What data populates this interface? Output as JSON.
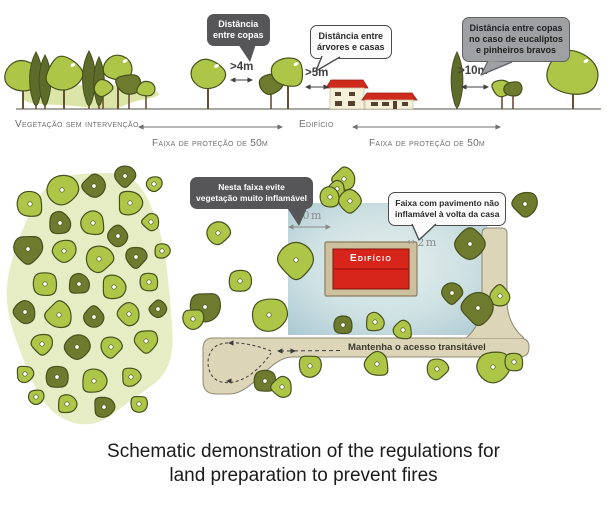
{
  "top_panel": {
    "bubble_copas": {
      "line1": "Distância",
      "line2": "entre copas"
    },
    "bubble_casas": {
      "line1": "Distância entre",
      "line2": "árvores e casas"
    },
    "bubble_eucaliptos": {
      "line1": "Distância entre copas",
      "line2": "no caso de eucaliptos",
      "line3": "e pinheiros bravos"
    },
    "meas_copas": ">4m",
    "meas_casas": ">5m",
    "meas_eucaliptos": ">10m",
    "label_vegetacao": "Vegetação sem intervenção",
    "label_edificio": "Edifício",
    "label_faixa_left": "Faixa de proteção de 50m",
    "label_faixa_right": "Faixa de proteção de 50m"
  },
  "bottom_panel": {
    "bubble_evite": {
      "line1": "Nesta faixa evite",
      "line2": "vegetação muito inflamável"
    },
    "bubble_pavimento": {
      "line1": "Faixa com pavimento não",
      "line2": "inflamável à volta da casa"
    },
    "meas_10m": "10m",
    "meas_2m": "2m",
    "meas_2m_arrow": "↔",
    "building_label": "Edifício",
    "road_label": "Mantenha o acesso transitável"
  },
  "caption": {
    "line1": "Schematic demonstration of the regulations for",
    "line2": "land preparation to prevent fires"
  },
  "colors": {
    "tree_light": "#adc647",
    "tree_dark": "#6e7a2e",
    "tree_outline": "#46511d",
    "cypress": "#5e6c2b",
    "cluster_bg": "#e6ecc3",
    "undergrowth": "#dbe5a8",
    "trunk": "#6b4f35",
    "ground": "#8b8b83",
    "label_gray": "#6f6f6f",
    "meas_gray": "#8a8a8a",
    "meas_dark": "#3f3f3f",
    "roof_red": "#cf2b1d",
    "wall_cream": "#f6efd9",
    "window_dark": "#54412e",
    "building_red": "#d8251c",
    "building_red_dark": "#a5150e",
    "building_frame": "#cdc09c",
    "building_frame_border": "#8a7d5e",
    "pavement": "#ddd5b8",
    "pavement_border": "#8f8874",
    "loop_line": "#3a3a3a",
    "yard_center": "#e6efef",
    "yard_edge": "#a8c7d1",
    "bubble_dark_bg": "#565659",
    "bubble_gray_bg": "#9fa0a3",
    "bubble_gray_border": "#626264",
    "bubble_light_bg": "#fbfbfb",
    "bubble_light_border": "#4d4d4f"
  },
  "scene": {
    "ground_y": 109,
    "top_trees": [
      {
        "t": "c",
        "x": 23,
        "y": 76,
        "rx": 20,
        "ry": 17,
        "s": "L"
      },
      {
        "t": "y",
        "x": 36,
        "top": 52,
        "h": 55,
        "w": 11
      },
      {
        "t": "y",
        "x": 45,
        "top": 55,
        "h": 52,
        "w": 10
      },
      {
        "t": "c",
        "x": 64,
        "y": 74,
        "rx": 20,
        "ry": 18,
        "s": "L"
      },
      {
        "t": "y",
        "x": 89,
        "top": 51,
        "h": 56,
        "w": 11
      },
      {
        "t": "y",
        "x": 99,
        "top": 57,
        "h": 50,
        "w": 9
      },
      {
        "t": "c",
        "x": 118,
        "y": 68,
        "rx": 16,
        "ry": 14,
        "s": "L"
      },
      {
        "t": "b",
        "x": 103,
        "y": 88,
        "rx": 10,
        "ry": 9,
        "s": "L"
      },
      {
        "t": "b",
        "x": 129,
        "y": 84,
        "rx": 14,
        "ry": 11,
        "s": "D"
      },
      {
        "t": "b",
        "x": 146,
        "y": 89,
        "rx": 10,
        "ry": 8,
        "s": "L"
      },
      {
        "t": "c",
        "x": 208,
        "y": 74,
        "rx": 19,
        "ry": 16,
        "s": "L"
      },
      {
        "t": "b",
        "x": 271,
        "y": 84,
        "rx": 13,
        "ry": 11,
        "s": "D"
      },
      {
        "t": "c",
        "x": 288,
        "y": 72,
        "rx": 18,
        "ry": 16,
        "s": "L"
      },
      {
        "t": "y",
        "x": 457,
        "top": 52,
        "h": 57,
        "w": 10
      },
      {
        "t": "b",
        "x": 502,
        "y": 88,
        "rx": 11,
        "ry": 9,
        "s": "L"
      },
      {
        "t": "b",
        "x": 513,
        "y": 89,
        "rx": 10,
        "ry": 8,
        "s": "D"
      },
      {
        "t": "c",
        "x": 573,
        "y": 73,
        "rx": 29,
        "ry": 24,
        "s": "L"
      }
    ],
    "cluster_trees": [
      [
        62,
        190,
        16,
        "L"
      ],
      [
        30,
        204,
        14,
        "L"
      ],
      [
        94,
        186,
        12,
        "D"
      ],
      [
        125,
        176,
        11,
        "D"
      ],
      [
        154,
        184,
        8,
        "L"
      ],
      [
        130,
        203,
        13,
        "L"
      ],
      [
        60,
        223,
        12,
        "D"
      ],
      [
        93,
        223,
        13,
        "L"
      ],
      [
        118,
        236,
        11,
        "D"
      ],
      [
        151,
        222,
        9,
        "L"
      ],
      [
        28,
        249,
        15,
        "D"
      ],
      [
        64,
        251,
        12,
        "L"
      ],
      [
        99,
        259,
        14,
        "L"
      ],
      [
        136,
        257,
        11,
        "D"
      ],
      [
        162,
        251,
        8,
        "L"
      ],
      [
        45,
        284,
        13,
        "L"
      ],
      [
        79,
        284,
        11,
        "D"
      ],
      [
        114,
        287,
        13,
        "L"
      ],
      [
        149,
        282,
        10,
        "L"
      ],
      [
        25,
        312,
        12,
        "D"
      ],
      [
        59,
        315,
        14,
        "L"
      ],
      [
        94,
        317,
        11,
        "D"
      ],
      [
        129,
        314,
        12,
        "L"
      ],
      [
        158,
        309,
        9,
        "D"
      ],
      [
        42,
        344,
        11,
        "L"
      ],
      [
        77,
        347,
        13,
        "D"
      ],
      [
        111,
        347,
        11,
        "L"
      ],
      [
        146,
        341,
        12,
        "L"
      ],
      [
        25,
        374,
        9,
        "L"
      ],
      [
        57,
        377,
        12,
        "D"
      ],
      [
        94,
        381,
        13,
        "L"
      ],
      [
        131,
        377,
        10,
        "L"
      ],
      [
        67,
        404,
        10,
        "L"
      ],
      [
        104,
        407,
        11,
        "D"
      ],
      [
        139,
        404,
        9,
        "L"
      ],
      [
        36,
        397,
        8,
        "L"
      ]
    ],
    "yard_trees": [
      [
        218,
        233,
        12,
        "L"
      ],
      [
        240,
        281,
        12,
        "L"
      ],
      [
        296,
        260,
        19,
        "L"
      ],
      [
        269,
        315,
        18,
        "L"
      ],
      [
        205,
        307,
        16,
        "D"
      ],
      [
        193,
        319,
        11,
        "L"
      ],
      [
        344,
        179,
        12,
        "L"
      ],
      [
        337,
        189,
        9,
        "L"
      ],
      [
        330,
        197,
        11,
        "L"
      ],
      [
        350,
        201,
        12,
        "L"
      ],
      [
        525,
        204,
        13,
        "D"
      ],
      [
        470,
        244,
        16,
        "D"
      ],
      [
        452,
        293,
        11,
        "D"
      ],
      [
        500,
        296,
        11,
        "L"
      ],
      [
        478,
        308,
        17,
        "D"
      ],
      [
        343,
        325,
        10,
        "D"
      ],
      [
        375,
        322,
        10,
        "L"
      ],
      [
        403,
        330,
        10,
        "L"
      ],
      [
        310,
        366,
        12,
        "L"
      ],
      [
        377,
        364,
        13,
        "L"
      ],
      [
        437,
        369,
        11,
        "L"
      ],
      [
        265,
        381,
        12,
        "D"
      ],
      [
        282,
        387,
        11,
        "L"
      ],
      [
        493,
        367,
        17,
        "L"
      ],
      [
        514,
        362,
        10,
        "L"
      ]
    ]
  }
}
